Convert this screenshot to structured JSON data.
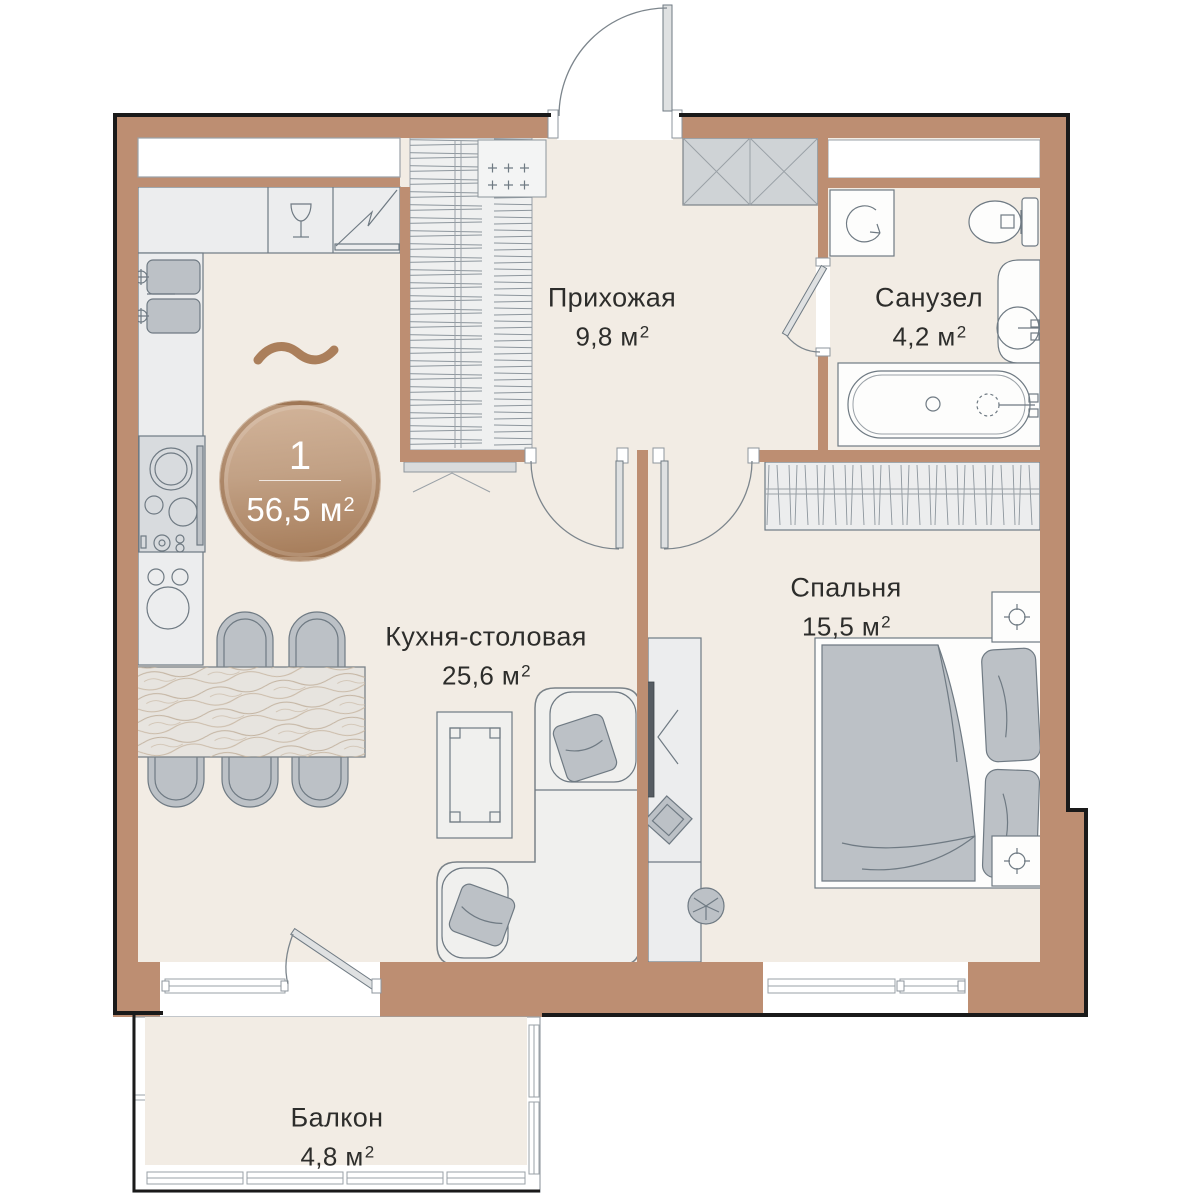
{
  "plan": {
    "type": "apartment-floor-plan",
    "language": "ru"
  },
  "badge": {
    "count": "1",
    "area": "56,5 м",
    "area_sup": "2"
  },
  "rooms": {
    "hallway": {
      "name": "Прихожая",
      "area": "9,8 м",
      "area_sup": "2"
    },
    "bathroom": {
      "name": "Санузел",
      "area": "4,2 м",
      "area_sup": "2"
    },
    "bedroom": {
      "name": "Спальня",
      "area": "15,5 м",
      "area_sup": "2"
    },
    "kitchen_dining": {
      "name": "Кухня-столовая",
      "area": "25,6 м",
      "area_sup": "2"
    },
    "balcony": {
      "name": "Балкон",
      "area": "4,8 м",
      "area_sup": "2"
    }
  },
  "colors": {
    "wall": "#bd8e72",
    "floor": "#f2ece4",
    "outline": "#1a1a1a",
    "line": "#6f7a83",
    "furn": "#bcc1c6",
    "light": "#ecedee",
    "accent": "#ab7f5b",
    "badge_top": "#d2b49a",
    "badge_bottom": "#a47a57",
    "text": "#2d2d2b"
  }
}
